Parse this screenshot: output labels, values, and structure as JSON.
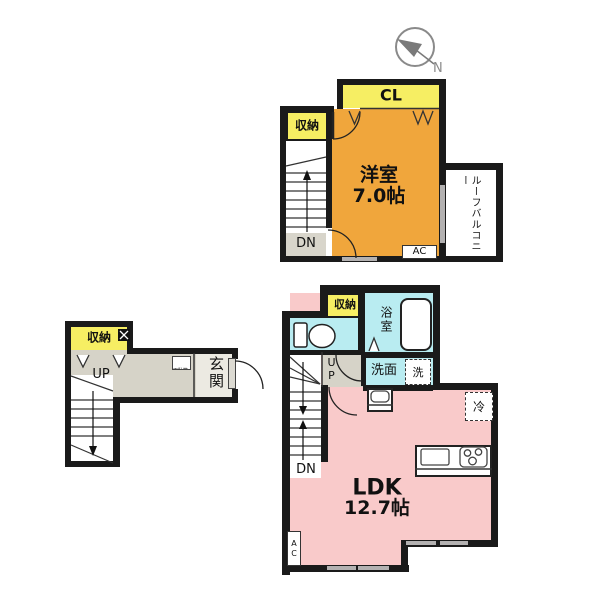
{
  "colors": {
    "wall": "#1a1a1a",
    "storage_yellow": "#f6ee63",
    "western_room_orange": "#f0a63c",
    "ldk_pink": "#f9caca",
    "wet_area_cyan": "#b9ecf1",
    "hallway_gray": "#d6d3c8",
    "window_gray": "#b3b1b1"
  },
  "compass": {
    "north_label": "N"
  },
  "upper_floor": {
    "closet": "CL",
    "storage": "収納",
    "room_name": "洋室",
    "room_size": "7.0帖",
    "stairs_down": "DN",
    "balcony": "ルーフバルコニー",
    "air_conditioner": "AC"
  },
  "entrance_floor": {
    "storage": "収納",
    "stairs_up": "UP",
    "entrance": "玄関",
    "shoe_cabinet": "下駄箱"
  },
  "main_floor": {
    "storage": "収納",
    "bathroom": "浴室",
    "washroom": "洗面",
    "laundry": "洗",
    "refrigerator": "冷",
    "stairs_up": "UP",
    "stairs_down": "DN",
    "living": "LDK",
    "living_size": "12.7帖",
    "air_conditioner": "AC"
  }
}
